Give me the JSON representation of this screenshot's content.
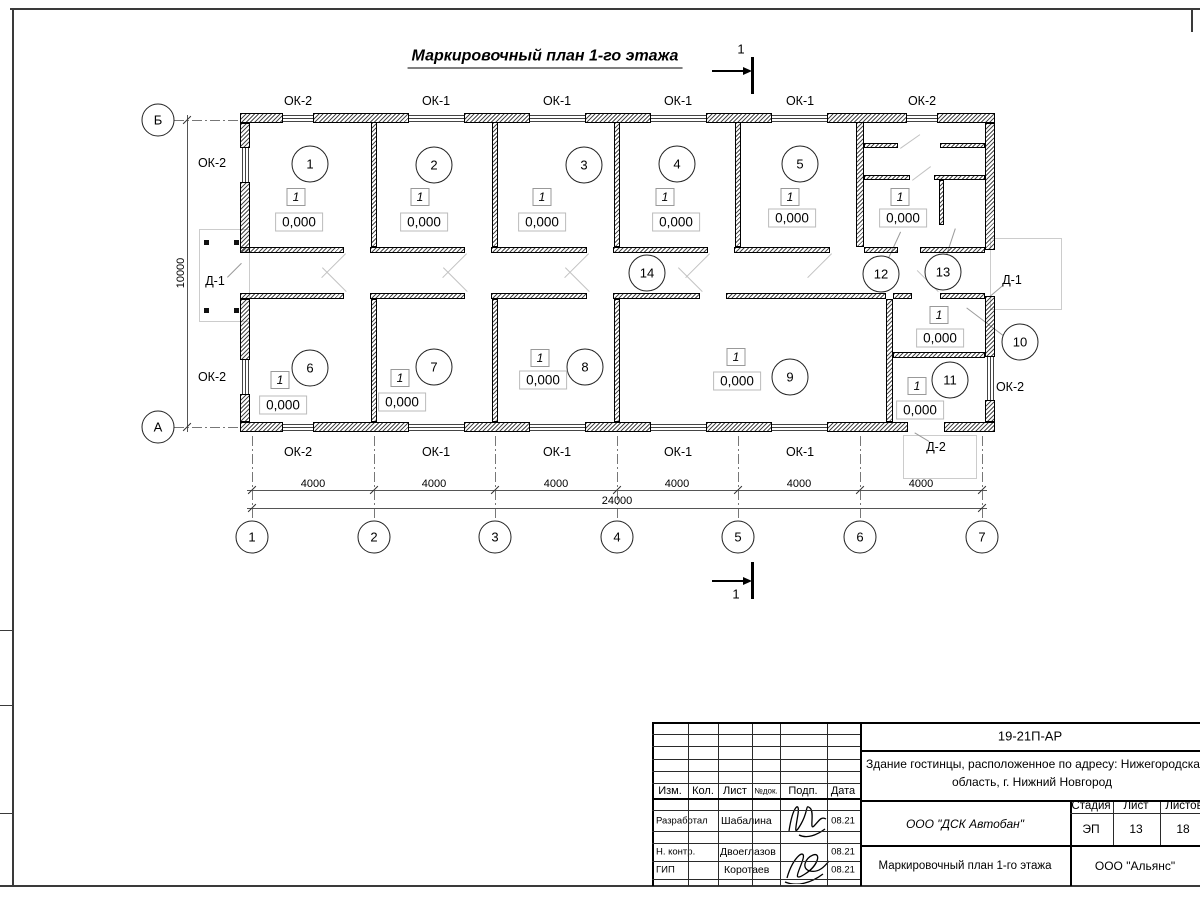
{
  "title": "Маркировочный план 1-го этажа",
  "section_mark_label": "1",
  "plan": {
    "flag_text": "1",
    "elevation_text": "0,000",
    "walls": [
      [
        240,
        113,
        43,
        10
      ],
      [
        313,
        113,
        96,
        10
      ],
      [
        464,
        113,
        66,
        10
      ],
      [
        585,
        113,
        66,
        10
      ],
      [
        706,
        113,
        66,
        10
      ],
      [
        827,
        113,
        80,
        10
      ],
      [
        937,
        113,
        58,
        10
      ],
      [
        240,
        422,
        43,
        10
      ],
      [
        313,
        422,
        96,
        10
      ],
      [
        464,
        422,
        66,
        10
      ],
      [
        585,
        422,
        66,
        10
      ],
      [
        706,
        422,
        66,
        10
      ],
      [
        827,
        422,
        81,
        10
      ],
      [
        944,
        422,
        51,
        10
      ],
      [
        240,
        123,
        10,
        25
      ],
      [
        240,
        182,
        10,
        71
      ],
      [
        240,
        299,
        10,
        61
      ],
      [
        240,
        394,
        10,
        28
      ],
      [
        985,
        123,
        10,
        127
      ],
      [
        985,
        296,
        10,
        61
      ],
      [
        985,
        400,
        10,
        22
      ],
      [
        371,
        122,
        6,
        125
      ],
      [
        492,
        122,
        6,
        125
      ],
      [
        614,
        122,
        6,
        125
      ],
      [
        735,
        122,
        6,
        125
      ],
      [
        856,
        122,
        8,
        125
      ],
      [
        371,
        299,
        6,
        123
      ],
      [
        492,
        299,
        6,
        123
      ],
      [
        614,
        299,
        6,
        123
      ],
      [
        886,
        299,
        7,
        123
      ],
      [
        893,
        352,
        92,
        6
      ],
      [
        240,
        247,
        104,
        6
      ],
      [
        370,
        247,
        95,
        6
      ],
      [
        491,
        247,
        96,
        6
      ],
      [
        613,
        247,
        95,
        6
      ],
      [
        734,
        247,
        96,
        6
      ],
      [
        864,
        247,
        34,
        6
      ],
      [
        920,
        247,
        65,
        6
      ],
      [
        240,
        293,
        104,
        6
      ],
      [
        370,
        293,
        95,
        6
      ],
      [
        491,
        293,
        96,
        6
      ],
      [
        613,
        293,
        87,
        6
      ],
      [
        726,
        293,
        160,
        6
      ],
      [
        893,
        293,
        19,
        6
      ],
      [
        940,
        293,
        45,
        6
      ],
      [
        864,
        143,
        34,
        5
      ],
      [
        940,
        143,
        45,
        5
      ],
      [
        864,
        175,
        46,
        5
      ],
      [
        934,
        175,
        51,
        5
      ],
      [
        939,
        180,
        5,
        45
      ]
    ],
    "windows_h": [
      [
        283,
        114.5,
        30,
        7
      ],
      [
        409,
        114.5,
        55,
        7
      ],
      [
        530,
        114.5,
        55,
        7
      ],
      [
        651,
        114.5,
        55,
        7
      ],
      [
        772,
        114.5,
        55,
        7
      ],
      [
        907,
        114.5,
        30,
        7
      ],
      [
        283,
        423.5,
        30,
        7
      ],
      [
        409,
        423.5,
        55,
        7
      ],
      [
        530,
        423.5,
        55,
        7
      ],
      [
        651,
        423.5,
        55,
        7
      ],
      [
        772,
        423.5,
        55,
        7
      ]
    ],
    "windows_v": [
      [
        241.5,
        148,
        7,
        34
      ],
      [
        241.5,
        360,
        7,
        34
      ],
      [
        986.5,
        357,
        7,
        43
      ]
    ],
    "window_labels": [
      [
        "ОК-2",
        298,
        101
      ],
      [
        "ОК-1",
        436,
        101
      ],
      [
        "ОК-1",
        557,
        101
      ],
      [
        "ОК-1",
        678,
        101
      ],
      [
        "ОК-1",
        800,
        101
      ],
      [
        "ОК-2",
        922,
        101
      ],
      [
        "ОК-2",
        298,
        452
      ],
      [
        "ОК-1",
        436,
        452
      ],
      [
        "ОК-1",
        557,
        452
      ],
      [
        "ОК-1",
        678,
        452
      ],
      [
        "ОК-1",
        800,
        452
      ],
      [
        "ОК-2",
        212,
        163
      ],
      [
        "ОК-2",
        212,
        377
      ],
      [
        "ОК-2",
        1010,
        387
      ]
    ],
    "door_labels": [
      [
        "Д-1",
        215,
        281
      ],
      [
        "Д-1",
        1012,
        280
      ],
      [
        "Д-2",
        936,
        447
      ]
    ],
    "rooms": [
      {
        "n": "1",
        "cx": 310,
        "cy": 164,
        "fx": 296,
        "fy": 197,
        "ex": 299,
        "ey": 222
      },
      {
        "n": "2",
        "cx": 434,
        "cy": 165,
        "fx": 420,
        "fy": 197,
        "ex": 424,
        "ey": 222
      },
      {
        "n": "3",
        "cx": 584,
        "cy": 165,
        "fx": 542,
        "fy": 197,
        "ex": 542,
        "ey": 222
      },
      {
        "n": "4",
        "cx": 677,
        "cy": 164,
        "fx": 665,
        "fy": 197,
        "ex": 676,
        "ey": 222
      },
      {
        "n": "5",
        "cx": 800,
        "cy": 164,
        "fx": 790,
        "fy": 197,
        "ex": 792,
        "ey": 218
      },
      {
        "n": "6",
        "cx": 310,
        "cy": 368,
        "fx": 280,
        "fy": 380,
        "ex": 283,
        "ey": 405
      },
      {
        "n": "7",
        "cx": 434,
        "cy": 367,
        "fx": 400,
        "fy": 378,
        "ex": 402,
        "ey": 402
      },
      {
        "n": "8",
        "cx": 585,
        "cy": 367,
        "fx": 540,
        "fy": 358,
        "ex": 543,
        "ey": 380
      },
      {
        "n": "9",
        "cx": 790,
        "cy": 377,
        "fx": 736,
        "fy": 357,
        "ex": 737,
        "ey": 381
      },
      {
        "n": "10",
        "cx": 1020,
        "cy": 342,
        "fx": 939,
        "fy": 315,
        "ex": 940,
        "ey": 338
      },
      {
        "n": "11",
        "cx": 950,
        "cy": 380,
        "fx": 917,
        "fy": 386,
        "ex": 920,
        "ey": 410
      },
      {
        "n": "12",
        "cx": 881,
        "cy": 274,
        "fx": 900,
        "fy": 197,
        "ex": 903,
        "ey": 218
      },
      {
        "n": "13",
        "cx": 943,
        "cy": 272
      },
      {
        "n": "14",
        "cx": 647,
        "cy": 273
      }
    ],
    "axes_cols": [
      {
        "label": "1",
        "x": 252
      },
      {
        "label": "2",
        "x": 374
      },
      {
        "label": "3",
        "x": 495
      },
      {
        "label": "4",
        "x": 617
      },
      {
        "label": "5",
        "x": 738
      },
      {
        "label": "6",
        "x": 860
      },
      {
        "label": "7",
        "x": 982
      }
    ],
    "axes_cols_cy": 537,
    "axes_rows": [
      {
        "label": "Б",
        "y": 120
      },
      {
        "label": "А",
        "y": 427
      }
    ],
    "axes_rows_cx": 158,
    "dim_labels": [
      [
        "4000",
        313,
        484
      ],
      [
        "4000",
        434,
        484
      ],
      [
        "4000",
        556,
        484
      ],
      [
        "4000",
        677,
        484
      ],
      [
        "4000",
        799,
        484
      ],
      [
        "4000",
        921,
        484
      ],
      [
        "24000",
        617,
        501
      ]
    ],
    "dim_v_label": "10000",
    "dim_v_pos": [
      181,
      273
    ],
    "ticks": [
      [
        252,
        490
      ],
      [
        374,
        490
      ],
      [
        495,
        490
      ],
      [
        617,
        490
      ],
      [
        738,
        490
      ],
      [
        860,
        490
      ],
      [
        982,
        490
      ],
      [
        252,
        508
      ],
      [
        982,
        508
      ],
      [
        187,
        120
      ],
      [
        187,
        427
      ]
    ],
    "swings": [
      [
        346,
        254,
        34,
        135
      ],
      [
        467,
        254,
        34,
        135
      ],
      [
        589,
        254,
        34,
        135
      ],
      [
        710,
        254,
        34,
        135
      ],
      [
        832,
        254,
        34,
        135
      ],
      [
        346,
        292,
        34,
        225
      ],
      [
        467,
        292,
        34,
        225
      ],
      [
        589,
        292,
        34,
        225
      ],
      [
        702,
        292,
        34,
        225
      ],
      [
        938,
        292,
        30,
        225
      ],
      [
        900,
        148,
        24,
        -35
      ],
      [
        912,
        180,
        23,
        -37
      ]
    ],
    "leaders": [
      [
        1003,
        336,
        966,
        308
      ],
      [
        888,
        258,
        900,
        232
      ],
      [
        946,
        255,
        955,
        228
      ],
      [
        227,
        277,
        241,
        263
      ],
      [
        1003,
        286,
        990,
        297
      ],
      [
        929,
        442,
        914,
        433
      ]
    ],
    "posts": [
      [
        204,
        240
      ],
      [
        234,
        240
      ],
      [
        204,
        308
      ],
      [
        234,
        308
      ]
    ],
    "porches": [
      [
        199,
        229,
        49,
        91
      ],
      [
        903,
        435,
        72,
        42
      ],
      [
        990,
        238,
        70,
        70
      ]
    ]
  },
  "titleblock": {
    "doc_code": "19-21П-АР",
    "address_line1": "Здание гостинцы, расположенное по адресу: Нижегородская",
    "address_line2": "область, г. Нижний Новгород",
    "cols": {
      "izm": "Изм.",
      "kol": "Кол.",
      "list": "Лист",
      "ndok": "№док.",
      "podp": "Подп.",
      "data": "Дата"
    },
    "stage_h": "Стадия",
    "sheet_h": "Лист",
    "sheets_h": "Листов",
    "stage": "ЭП",
    "sheet": "13",
    "sheets": "18",
    "rows": [
      {
        "role": "Разработал",
        "name": "Шабалина",
        "date": "08.21"
      },
      {
        "role": "Н. контр.",
        "name": "Двоеглазов",
        "date": "08.21"
      },
      {
        "role": "ГИП",
        "name": "Коротаев",
        "date": "08.21"
      }
    ],
    "org": "ООО \"ДСК Автобан\"",
    "sheet_title": "Маркировочный план 1-го этажа",
    "firm": "ООО \"Альянс\"",
    "vlines": [
      [
        688,
        722,
        886,
        0
      ],
      [
        718,
        722,
        886,
        0
      ],
      [
        752,
        722,
        886,
        0
      ],
      [
        780,
        722,
        886,
        0
      ],
      [
        827,
        722,
        886,
        0
      ],
      [
        860,
        722,
        886,
        1
      ],
      [
        1070,
        800,
        886,
        1
      ],
      [
        1113,
        800,
        845,
        0
      ],
      [
        1160,
        800,
        845,
        0
      ],
      [
        652,
        722,
        886,
        1
      ]
    ],
    "hlines": [
      [
        722,
        652,
        1200,
        1
      ],
      [
        734,
        652,
        860,
        0
      ],
      [
        746,
        652,
        860,
        0
      ],
      [
        759,
        652,
        860,
        0
      ],
      [
        771,
        652,
        860,
        0
      ],
      [
        783,
        652,
        860,
        0
      ],
      [
        798,
        652,
        860,
        1
      ],
      [
        810,
        652,
        860,
        0
      ],
      [
        831,
        652,
        860,
        0
      ],
      [
        843,
        652,
        860,
        0
      ],
      [
        861,
        652,
        860,
        0
      ],
      [
        879,
        652,
        860,
        0
      ],
      [
        750,
        860,
        1200,
        1
      ],
      [
        800,
        860,
        1200,
        1
      ],
      [
        813,
        1070,
        1200,
        0
      ],
      [
        845,
        860,
        1200,
        1
      ]
    ]
  }
}
